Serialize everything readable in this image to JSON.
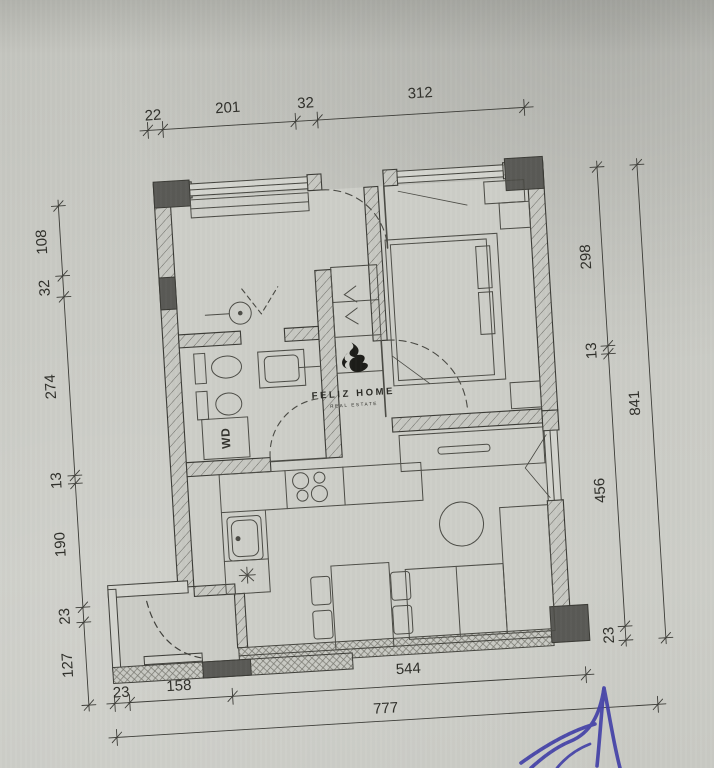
{
  "dims": {
    "top": [
      "22",
      "201",
      "32",
      "312"
    ],
    "left": [
      "108",
      "32",
      "274",
      "13",
      "190",
      "23",
      "127"
    ],
    "right_inner": [
      "298",
      "13",
      "456",
      "23"
    ],
    "right_outer": "841",
    "bottom_inner": [
      "23",
      "158",
      "544"
    ],
    "bottom_outer": "777"
  },
  "logo": {
    "title": "FELIZ HOME",
    "subtitle": "REAL ESTATE"
  },
  "labels": {
    "washer_dryer": "WD"
  },
  "icons": {
    "flame_logo": "flame",
    "star_fixture": "asterisk-light-point"
  },
  "colors": {
    "paper": "#cacbc5",
    "ink": "#3c3c37",
    "column_fill": "#57575302",
    "column": "#5a5a56",
    "signature_blue": "#4341a8"
  }
}
